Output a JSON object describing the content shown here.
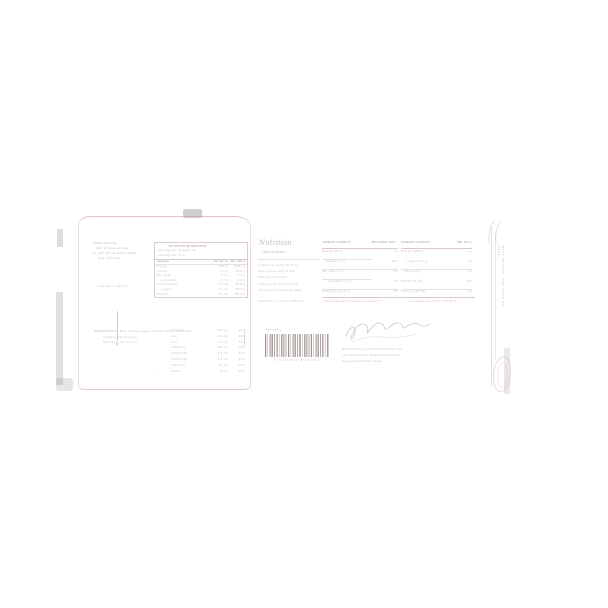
{
  "colors": {
    "label_pink": "#c8a0a0",
    "text_faint": "#8f6f6d",
    "background_gray": "#8f8a88",
    "barcode_ink": "#6f5652"
  },
  "pouch": {
    "info_lines": [
      "PREPARATION:",
      "Add 2 level scoops",
      "to 200 mL of warm water",
      "and mix well."
    ],
    "note": "1 scoop = 12.5 g"
  },
  "nutrition_table": {
    "title": "NUTRITION INFORMATION",
    "sub1": "Servings per package: 16",
    "sub2": "Serving size: 25 g",
    "col_avg": "Average",
    "col_serve": "Per Serve",
    "col_100g": "Per 100 g",
    "rows": [
      {
        "name": "Energy",
        "v1": "420 kJ",
        "v2": "1680 kJ"
      },
      {
        "name": "Protein",
        "v1": "5.2 g",
        "v2": "20.8 g"
      },
      {
        "name": "Fat, total",
        "v1": "1.1 g",
        "v2": "4.4 g"
      },
      {
        "name": "- saturated",
        "v1": "0.7 g",
        "v2": "2.8 g"
      },
      {
        "name": "Carbohydrate",
        "v1": "17.2 g",
        "v2": "68.8 g"
      },
      {
        "name": "- sugars",
        "v1": "12.4 g",
        "v2": "49.6 g"
      },
      {
        "name": "Sodium",
        "v1": "45 mg",
        "v2": "180 mg"
      }
    ]
  },
  "ingredients": {
    "heading": "INGREDIENTS: Milk solids, sugar, cocoa (10%), minerals",
    "line1": "Contains milk and soy.",
    "line2": "Store in a cool, dry place.",
    "mark": "..."
  },
  "minerals_table": {
    "rows": [
      {
        "name": "Calcium",
        "v1": "160 mg",
        "v2": "20%"
      },
      {
        "name": "Iron",
        "v1": "3.0 mg",
        "v2": "25%"
      },
      {
        "name": "Zinc",
        "v1": "1.5 mg",
        "v2": "12%"
      },
      {
        "name": "Vitamin A",
        "v1": "120 ug",
        "v2": "16%"
      },
      {
        "name": "Vitamin B1",
        "v1": "0.3 mg",
        "v2": "27%"
      },
      {
        "name": "Vitamin B2",
        "v1": "0.4 mg",
        "v2": "25%"
      },
      {
        "name": "Vitamin C",
        "v1": "10 mg",
        "v2": "25%"
      },
      {
        "name": "Folate",
        "v1": "50 ug",
        "v2": "25%"
      }
    ]
  },
  "info_panel": {
    "title": "Nutrition",
    "subtitle": "Information",
    "paragraph_lines": [
      "A delicious malted drink to",
      "enjoy at any time of day.",
      "Best served chilled.",
      "Prepare with milk for extra",
      "calcium and a creamier taste.",
      "Serve hot or cold as preferred."
    ],
    "mid_list": {
      "header_left": "AVERAGE QUANTITY",
      "header_right": "PER SERVE %DI*",
      "rows": [
        {
          "name": "Energy 420 kJ",
          "value": "5%"
        },
        {
          "name": "Protein 5.2 g",
          "value": "10%"
        },
        {
          "name": "Fat, total 1.1 g",
          "value": "2%"
        },
        {
          "name": "- saturated 0.7 g",
          "value": "3%"
        },
        {
          "name": "Carbohydrate 17 g",
          "value": "6%"
        }
      ]
    },
    "right_list": {
      "header_left": "AVERAGE QUANTITY",
      "header_right": "PER 100 g",
      "rows": [
        {
          "name": "Energy 1680 kJ",
          "value": "1 g"
        },
        {
          "name": "- sugars 12.4 g",
          "value": "2%"
        },
        {
          "name": "Fibre 1.6 g",
          "value": "4%"
        },
        {
          "name": "Sodium 45 mg",
          "value": "6%"
        },
        {
          "name": "Calcium 160 mg",
          "value": "5%"
        }
      ]
    },
    "footnote_left": "*Percentage Daily Intakes are based on",
    "footnote_right": "an average adult diet of 8700 kJ."
  },
  "barcode": {
    "top_label": "NET 400 G",
    "digits": "9 312345 678901"
  },
  "manufacturer": {
    "lines": [
      "Manufactured by Example Foods Pty Ltd",
      "123 Sample Road, Melbourne VIC 3000",
      "www.examplefoods.com.au"
    ]
  },
  "side_text": "BEST BEFORE: SEE BASE OF PACK"
}
